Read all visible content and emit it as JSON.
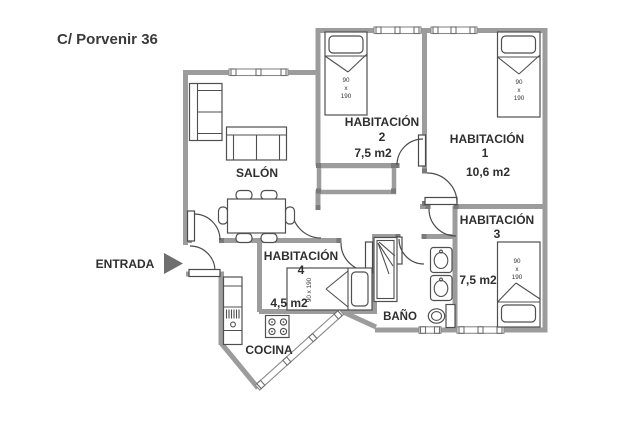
{
  "title": "C/ Porvenir 36",
  "entrance": {
    "label": "ENTRADA"
  },
  "rooms": {
    "salon": {
      "label": "SALÓN"
    },
    "hab1": {
      "name": "HABITACIÓN",
      "number": "1",
      "area": "10,6  m2"
    },
    "hab2": {
      "name": "HABITACIÓN",
      "number": "2",
      "area": "7,5 m2"
    },
    "hab3": {
      "name": "HABITACIÓN",
      "number": "3",
      "area": "7,5 m2"
    },
    "hab4": {
      "name": "HABITACIÓN",
      "number": "4",
      "area": "4,5 m2"
    },
    "bano": {
      "label": "BAÑO"
    },
    "cocina": {
      "label": "COCINA"
    }
  },
  "bed_label": {
    "width": "90",
    "sep": "x",
    "length": "190",
    "full": "90 x 190"
  },
  "colors": {
    "wall": "#9c9c9c",
    "furniture_outline": "#4f4f4f",
    "text": "#2f2f2f",
    "arrow": "#6f6f6f"
  }
}
